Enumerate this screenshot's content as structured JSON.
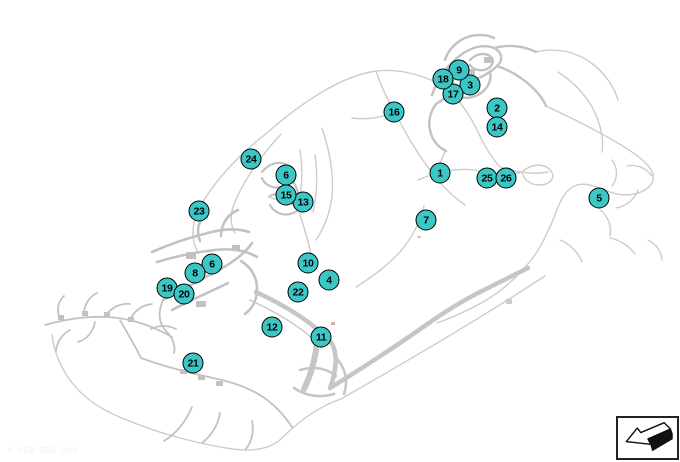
{
  "theme": {
    "background": "#ffffff",
    "harness_line_color": "#cccccc",
    "harness_dense_color": "#c2c2c2",
    "callout_fill": "#3cc7c7",
    "callout_border": "#000000",
    "callout_text_color": "#000000",
    "icon_border_color": "#222222"
  },
  "diagram": {
    "watermark": "0 000 000 000",
    "callouts": [
      {
        "label": "1",
        "x": 440,
        "y": 173
      },
      {
        "label": "2",
        "x": 497,
        "y": 108
      },
      {
        "label": "3",
        "x": 470,
        "y": 85
      },
      {
        "label": "4",
        "x": 329,
        "y": 280
      },
      {
        "label": "5",
        "x": 599,
        "y": 198
      },
      {
        "label": "6",
        "x": 286,
        "y": 175
      },
      {
        "label": "6",
        "x": 212,
        "y": 264
      },
      {
        "label": "7",
        "x": 426,
        "y": 220
      },
      {
        "label": "8",
        "x": 195,
        "y": 273
      },
      {
        "label": "9",
        "x": 459,
        "y": 70
      },
      {
        "label": "10",
        "x": 308,
        "y": 263
      },
      {
        "label": "11",
        "x": 321,
        "y": 337
      },
      {
        "label": "12",
        "x": 272,
        "y": 327
      },
      {
        "label": "13",
        "x": 303,
        "y": 202
      },
      {
        "label": "14",
        "x": 497,
        "y": 127
      },
      {
        "label": "15",
        "x": 286,
        "y": 195
      },
      {
        "label": "16",
        "x": 394,
        "y": 112
      },
      {
        "label": "17",
        "x": 453,
        "y": 94
      },
      {
        "label": "18",
        "x": 443,
        "y": 79
      },
      {
        "label": "19",
        "x": 167,
        "y": 288
      },
      {
        "label": "20",
        "x": 184,
        "y": 294
      },
      {
        "label": "21",
        "x": 193,
        "y": 363
      },
      {
        "label": "22",
        "x": 298,
        "y": 292
      },
      {
        "label": "23",
        "x": 199,
        "y": 211
      },
      {
        "label": "24",
        "x": 251,
        "y": 159
      },
      {
        "label": "25",
        "x": 487,
        "y": 178
      },
      {
        "label": "26",
        "x": 506,
        "y": 178
      }
    ]
  },
  "icons": {
    "bottom_right": "direction-arrow-icon"
  }
}
